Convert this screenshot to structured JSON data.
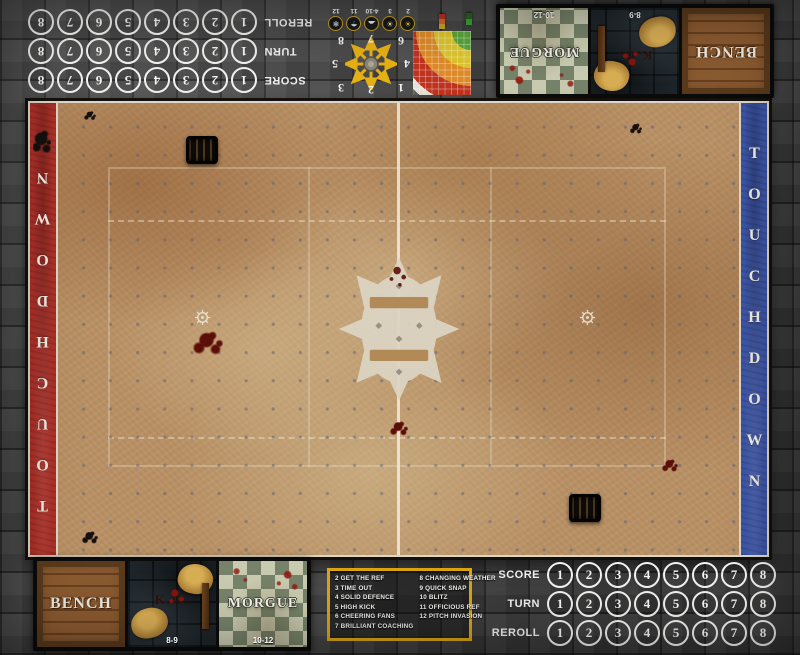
{
  "tracks": {
    "rows": [
      {
        "label": "SCORE",
        "numbers": [
          "1",
          "2",
          "3",
          "4",
          "5",
          "6",
          "7",
          "8"
        ]
      },
      {
        "label": "TURN",
        "numbers": [
          "1",
          "2",
          "3",
          "4",
          "5",
          "6",
          "7",
          "8"
        ]
      },
      {
        "label": "REROLL",
        "numbers": [
          "1",
          "2",
          "3",
          "4",
          "5",
          "6",
          "7",
          "8"
        ]
      }
    ]
  },
  "endzones": {
    "left": {
      "label": "TOUCHDOWN",
      "color": "#ae3129"
    },
    "right": {
      "label": "TOUCHDOWN",
      "color": "#3d55a6"
    }
  },
  "dugout": {
    "boxes": [
      {
        "label": "BENCH"
      },
      {
        "label": "K.O.",
        "range": "8-9"
      },
      {
        "label": "MORGUE",
        "range": "10-12"
      }
    ]
  },
  "weather": {
    "items": [
      {
        "label": "2",
        "icon": "sun-icon",
        "glyph": "☀"
      },
      {
        "label": "3",
        "icon": "very-sunny-icon",
        "glyph": "☀"
      },
      {
        "label": "4-10",
        "icon": "cloud-icon",
        "glyph": "☁"
      },
      {
        "label": "11",
        "icon": "rain-icon",
        "glyph": "☂"
      },
      {
        "label": "12",
        "icon": "snow-icon",
        "glyph": "❄"
      }
    ]
  },
  "scatter": {
    "numbers": [
      "1",
      "2",
      "3",
      "4",
      "5",
      "6",
      "7",
      "8"
    ]
  },
  "kickoff_table": {
    "left": [
      "2 GET THE REF",
      "3 TIME OUT",
      "4 SOLID DEFENCE",
      "5 HIGH KICK",
      "6 CHEERING FANS",
      "7 BRILLIANT COACHING"
    ],
    "right": [
      "8 CHANGING WEATHER",
      "9 QUICK SNAP",
      "10 BLITZ",
      "11 OFFICIOUS REF",
      "12 PITCH INVASION"
    ]
  },
  "colors": {
    "accent_yellow": "#d8a414",
    "endzone_red": "#ae3129",
    "endzone_blue": "#3d55a6",
    "track_circle": "#f2f2f0"
  }
}
